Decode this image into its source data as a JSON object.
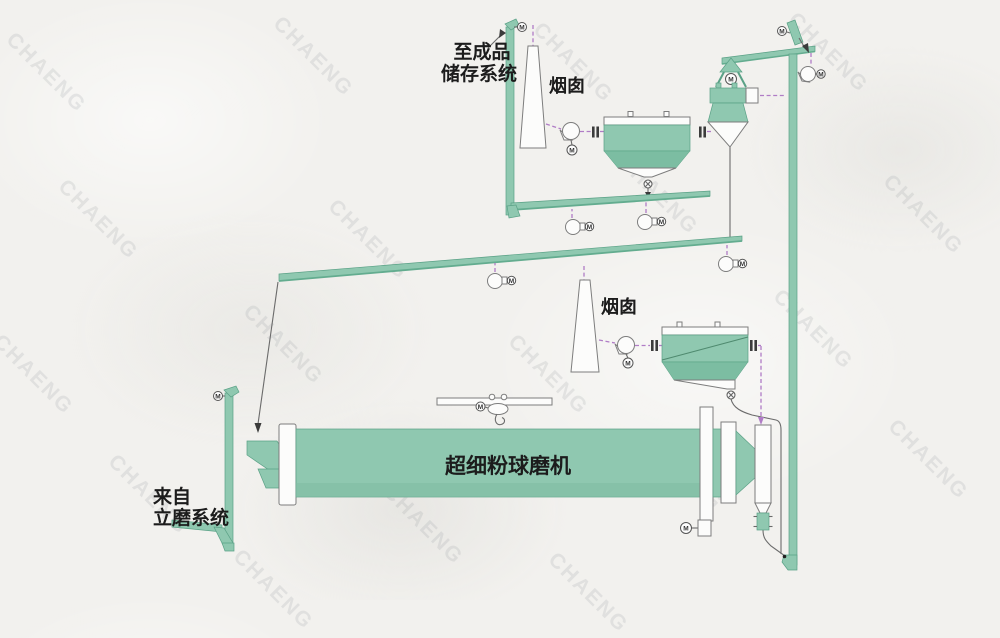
{
  "diagram": {
    "labels": {
      "to_storage_1": "至成品",
      "to_storage_2": "储存系统",
      "chimney_1": "烟囱",
      "chimney_2": "烟囱",
      "mill": "超细粉球磨机",
      "from_mill_1": "来自",
      "from_mill_2": "立磨系统",
      "motor": "M"
    },
    "colors": {
      "equipment_green": "#8fc8b0",
      "equipment_green_dark": "#7cbda2",
      "outline_gray": "#7d7d7d",
      "air_duct_purple": "#b07cc6",
      "background_paper": "#f2f1ee",
      "label_text": "#1c1c1c"
    }
  },
  "watermark": {
    "text": "CHAENG"
  }
}
